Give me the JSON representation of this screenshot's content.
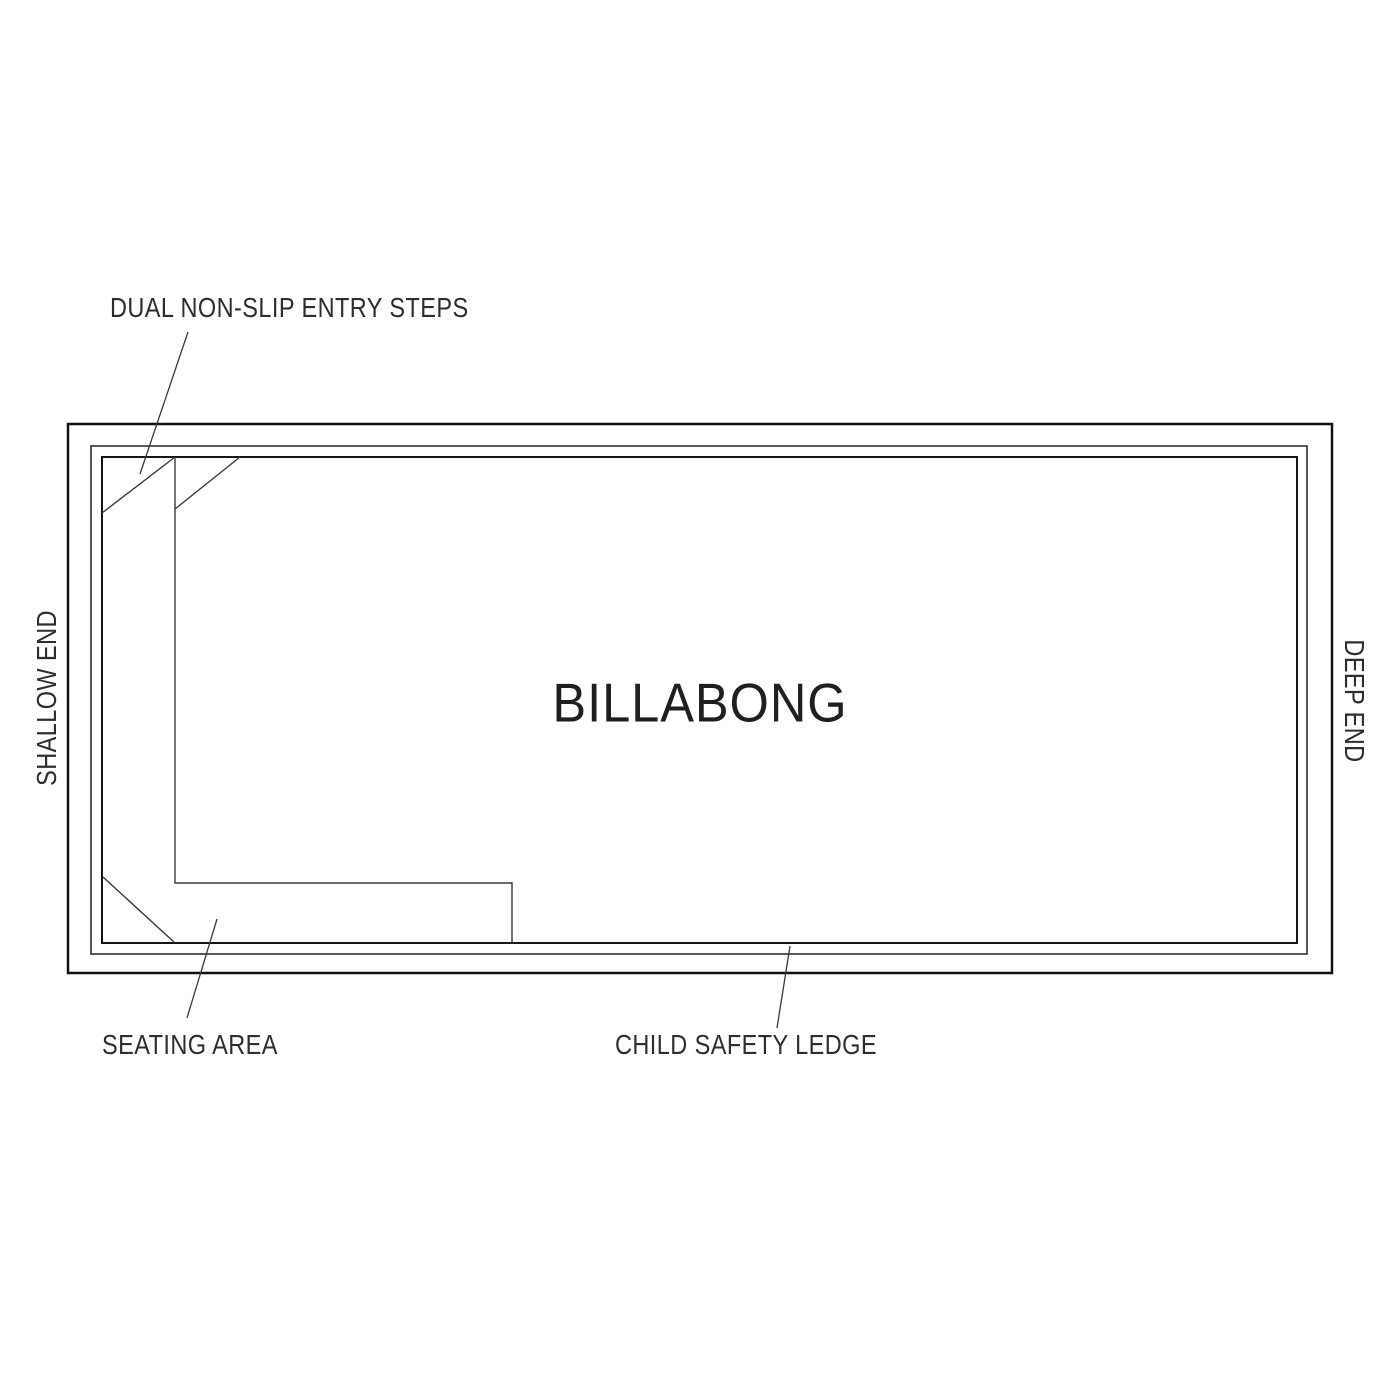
{
  "diagram": {
    "pool_name": "BILLABONG",
    "side_labels": {
      "shallow_end": "SHALLOW END",
      "deep_end": "DEEP END"
    },
    "feature_labels": {
      "entry_steps": "DUAL NON-SLIP ENTRY STEPS",
      "seating_area": "SEATING AREA",
      "child_safety_ledge": "CHILD SAFETY LEDGE"
    },
    "colors": {
      "outline": "#111111",
      "feature_line": "#3a3a3a",
      "text": "#2e2e2e",
      "background": "#ffffff"
    }
  }
}
